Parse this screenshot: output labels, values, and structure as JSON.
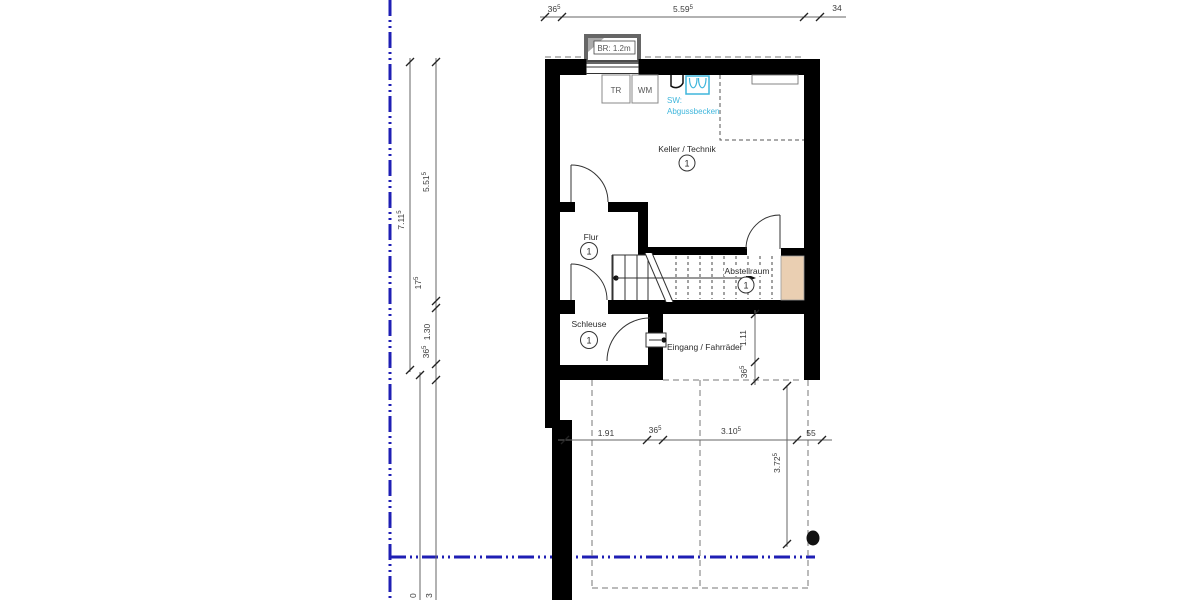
{
  "meta": {
    "drawing_type": "architectural-floor-plan",
    "floor": "basement"
  },
  "rooms": {
    "keller": {
      "name": "Keller / Technik",
      "number": "1"
    },
    "flur": {
      "name": "Flur",
      "number": "1"
    },
    "schleuse": {
      "name": "Schleuse",
      "number": "1"
    },
    "abstellraum": {
      "name": "Abstellraum",
      "number": "1"
    }
  },
  "annotations": {
    "entrance": "Eingang / Fahrräder",
    "lightwell": "BR: 1.2m",
    "appliance_tr": "TR",
    "appliance_wm": "WM",
    "sink_line1": "SW:",
    "sink_line2": "Abgussbecken"
  },
  "dims": {
    "top": [
      {
        "value": "36",
        "sup": "5"
      },
      {
        "value": "5.59",
        "sup": "5"
      },
      {
        "value": "34",
        "sup": ""
      }
    ],
    "left_outer": {
      "value": "7.11",
      "sup": "5"
    },
    "left_inner": [
      {
        "value": "5.51",
        "sup": "5"
      },
      {
        "value": "17",
        "sup": "5"
      },
      {
        "value": "1.30",
        "sup": ""
      },
      {
        "value": "36",
        "sup": "5"
      }
    ],
    "bottom": [
      {
        "value": "1.91",
        "sup": ""
      },
      {
        "value": "36",
        "sup": "5"
      },
      {
        "value": "3.10",
        "sup": "5"
      },
      {
        "value": "55",
        "sup": ""
      }
    ],
    "right_upper": [
      {
        "value": "1.11",
        "sup": ""
      },
      {
        "value": "36",
        "sup": "5"
      }
    ],
    "right_lower": {
      "value": "3.72",
      "sup": "5"
    },
    "edge_fragments": [
      "0",
      "3"
    ]
  },
  "colors": {
    "boundary_blue": "#1f1fb4",
    "plumbing_cyan": "#3fb6dc",
    "wall_black": "#000000",
    "lightwell_beige": "#eacfb2",
    "dimension_gray": "#666666"
  }
}
